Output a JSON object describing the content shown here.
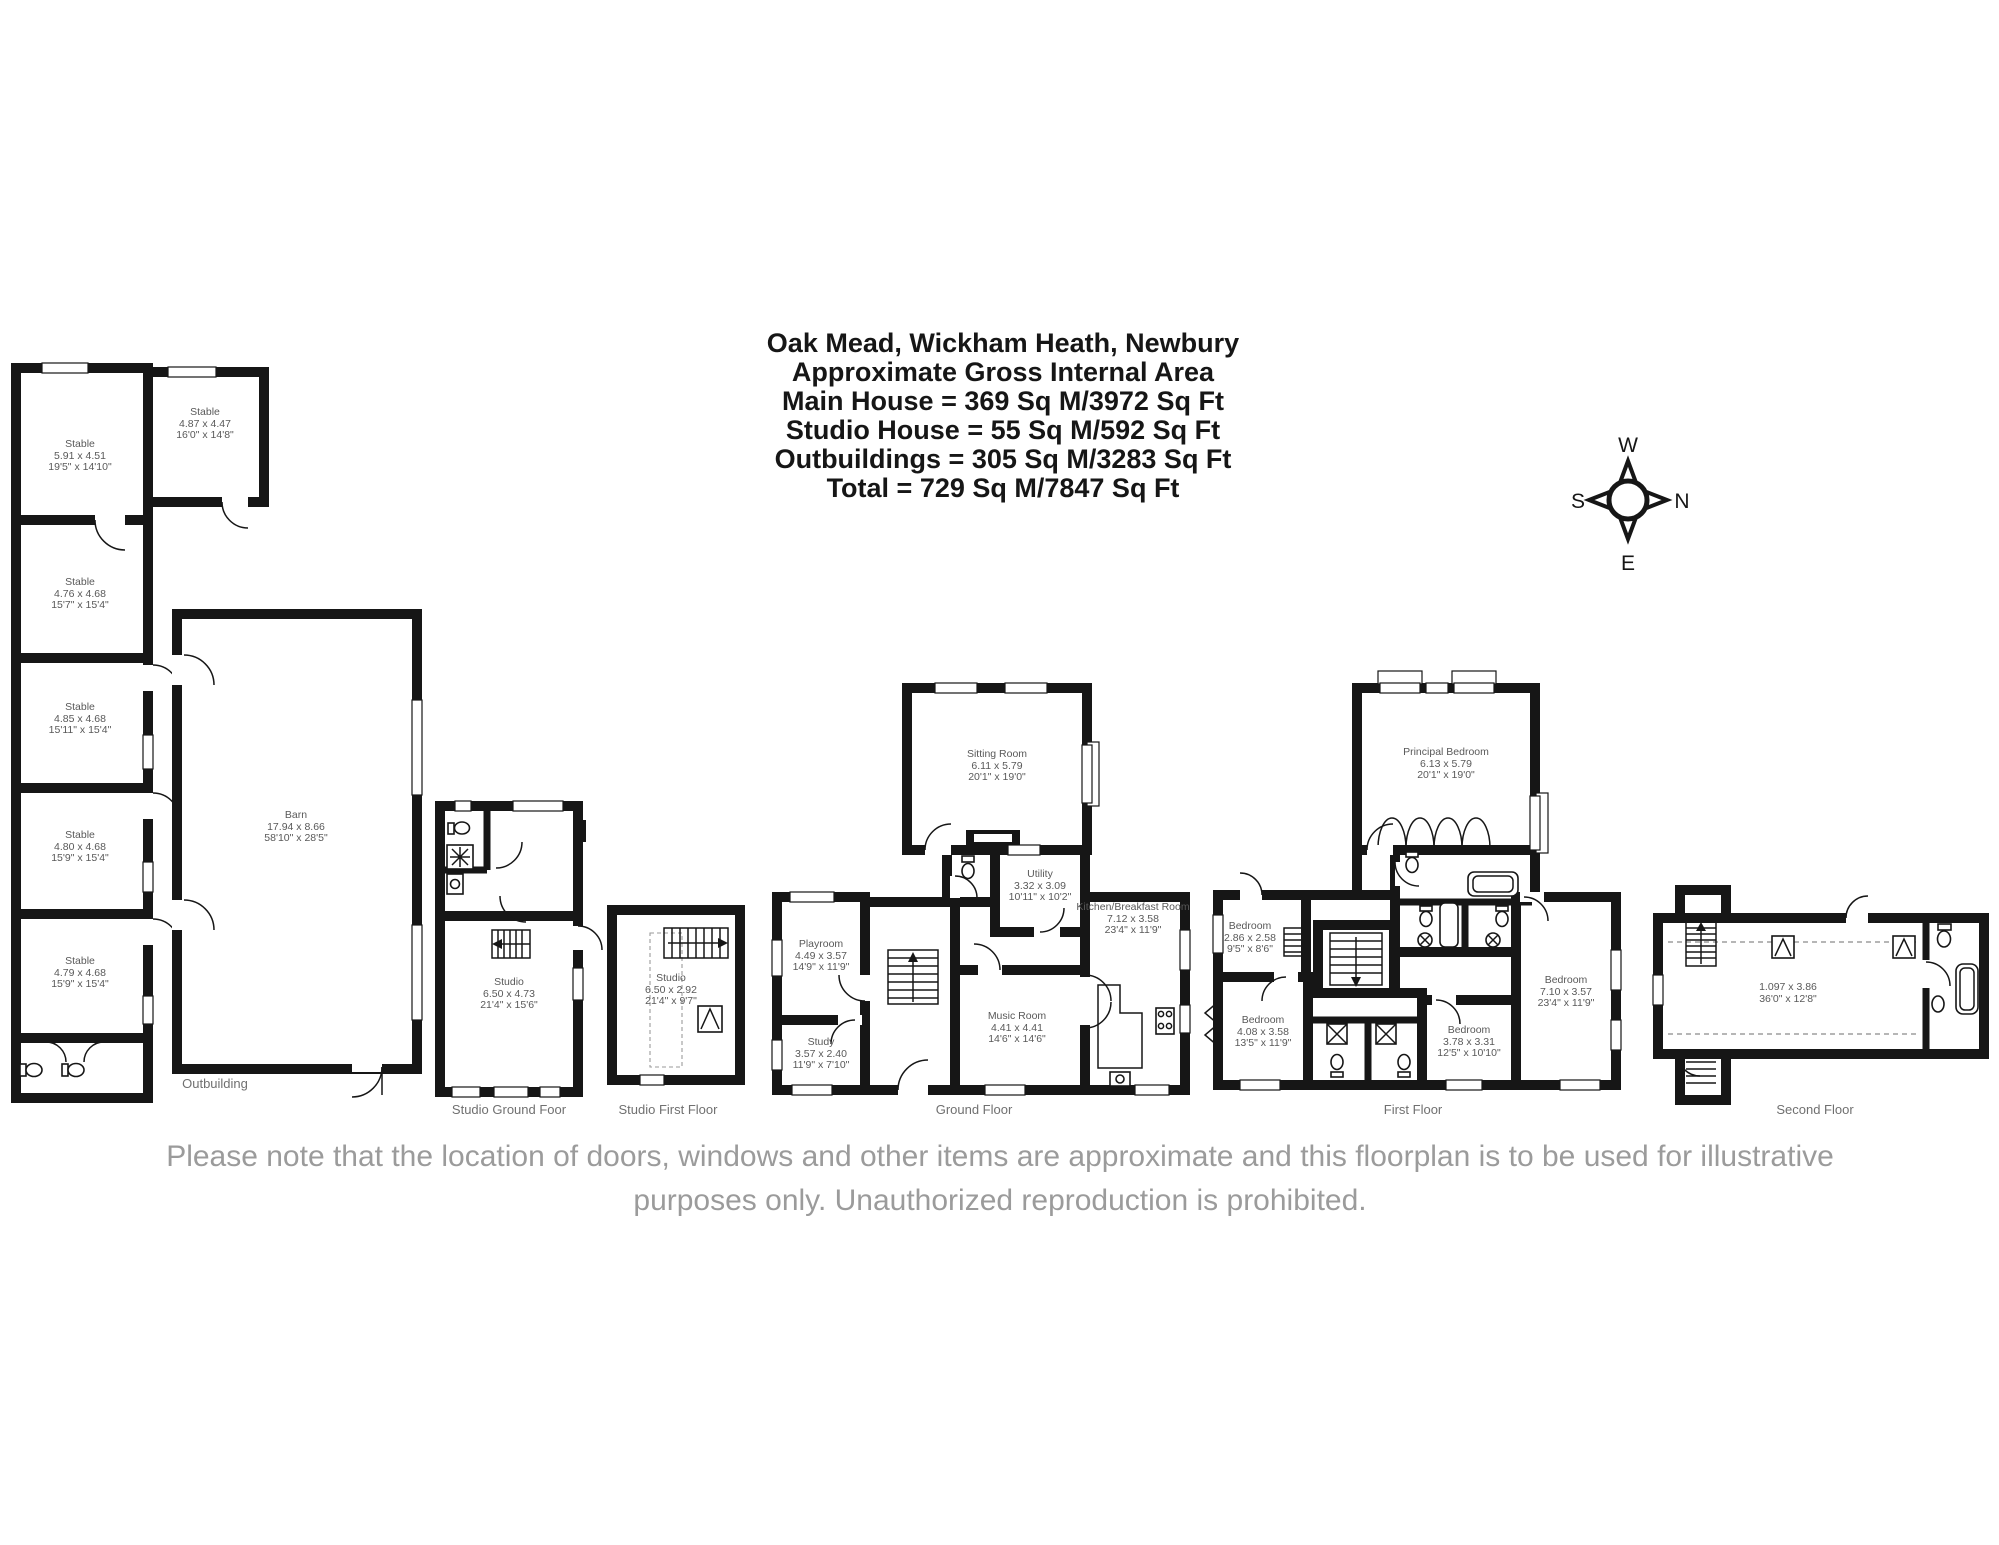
{
  "title": {
    "lines": [
      "Oak Mead, Wickham Heath, Newbury",
      "Approximate Gross Internal Area",
      "Main House = 369 Sq M/3972 Sq Ft",
      "Studio House = 55 Sq M/592 Sq Ft",
      "Outbuildings = 305 Sq M/3283 Sq Ft",
      "Total = 729 Sq M/7847 Sq Ft"
    ]
  },
  "compass": {
    "top": "W",
    "left": "S",
    "right": "N",
    "bottom": "E"
  },
  "sections": [
    {
      "label": "Outbuilding"
    },
    {
      "label": "Studio Ground Foor"
    },
    {
      "label": "Studio First Floor"
    },
    {
      "label": "Ground Floor"
    },
    {
      "label": "First Floor"
    },
    {
      "label": "Second Floor"
    }
  ],
  "rooms": [
    {
      "name": "Stable",
      "metric": "5.91 x 4.51",
      "imperial": "19'5\" x 14'10\""
    },
    {
      "name": "Stable",
      "metric": "4.87 x 4.47",
      "imperial": "16'0\" x 14'8\""
    },
    {
      "name": "Stable",
      "metric": "4.76 x 4.68",
      "imperial": "15'7\" x 15'4\""
    },
    {
      "name": "Stable",
      "metric": "4.85 x 4.68",
      "imperial": "15'11\" x 15'4\""
    },
    {
      "name": "Stable",
      "metric": "4.80 x 4.68",
      "imperial": "15'9\" x 15'4\""
    },
    {
      "name": "Stable",
      "metric": "4.79 x 4.68",
      "imperial": "15'9\" x 15'4\""
    },
    {
      "name": "Barn",
      "metric": "17.94 x 8.66",
      "imperial": "58'10\" x 28'5\""
    },
    {
      "name": "Studio",
      "metric": "6.50 x 4.73",
      "imperial": "21'4\" x 15'6\""
    },
    {
      "name": "Studio",
      "metric": "6.50 x 2.92",
      "imperial": "21'4\" x 9'7\""
    },
    {
      "name": "Sitting Room",
      "metric": "6.11 x 5.79",
      "imperial": "20'1\" x 19'0\""
    },
    {
      "name": "Utility",
      "metric": "3.32 x 3.09",
      "imperial": "10'11\" x 10'2\""
    },
    {
      "name": "Kitchen/Breakfast Room",
      "metric": "7.12 x 3.58",
      "imperial": "23'4\" x 11'9\""
    },
    {
      "name": "Playroom",
      "metric": "4.49 x 3.57",
      "imperial": "14'9\" x 11'9\""
    },
    {
      "name": "Music Room",
      "metric": "4.41 x 4.41",
      "imperial": "14'6\" x 14'6\""
    },
    {
      "name": "Study",
      "metric": "3.57 x 2.40",
      "imperial": "11'9\" x 7'10\""
    },
    {
      "name": "Principal Bedroom",
      "metric": "6.13 x 5.79",
      "imperial": "20'1\" x 19'0\""
    },
    {
      "name": "Bedroom",
      "metric": "2.86 x 2.58",
      "imperial": "9'5\" x 8'6\""
    },
    {
      "name": "Bedroom",
      "metric": "4.08 x 3.58",
      "imperial": "13'5\" x 11'9\""
    },
    {
      "name": "Bedroom",
      "metric": "7.10 x 3.57",
      "imperial": "23'4\" x 11'9\""
    },
    {
      "name": "Bedroom",
      "metric": "3.78 x 3.31",
      "imperial": "12'5\" x 10'10\""
    },
    {
      "name": "",
      "metric": "1.097 x 3.86",
      "imperial": "36'0\" x 12'8\""
    }
  ],
  "disclaimer": {
    "line1": "Please note that the location of doors, windows and other items are approximate and this floorplan is to be used for illustrative",
    "line2": "purposes only. Unauthorized reproduction is prohibited."
  },
  "colors": {
    "wall": "#161616",
    "room_label": "#595959",
    "section_label": "#707070",
    "disclaimer": "#9b9b9b",
    "background": "#ffffff"
  }
}
